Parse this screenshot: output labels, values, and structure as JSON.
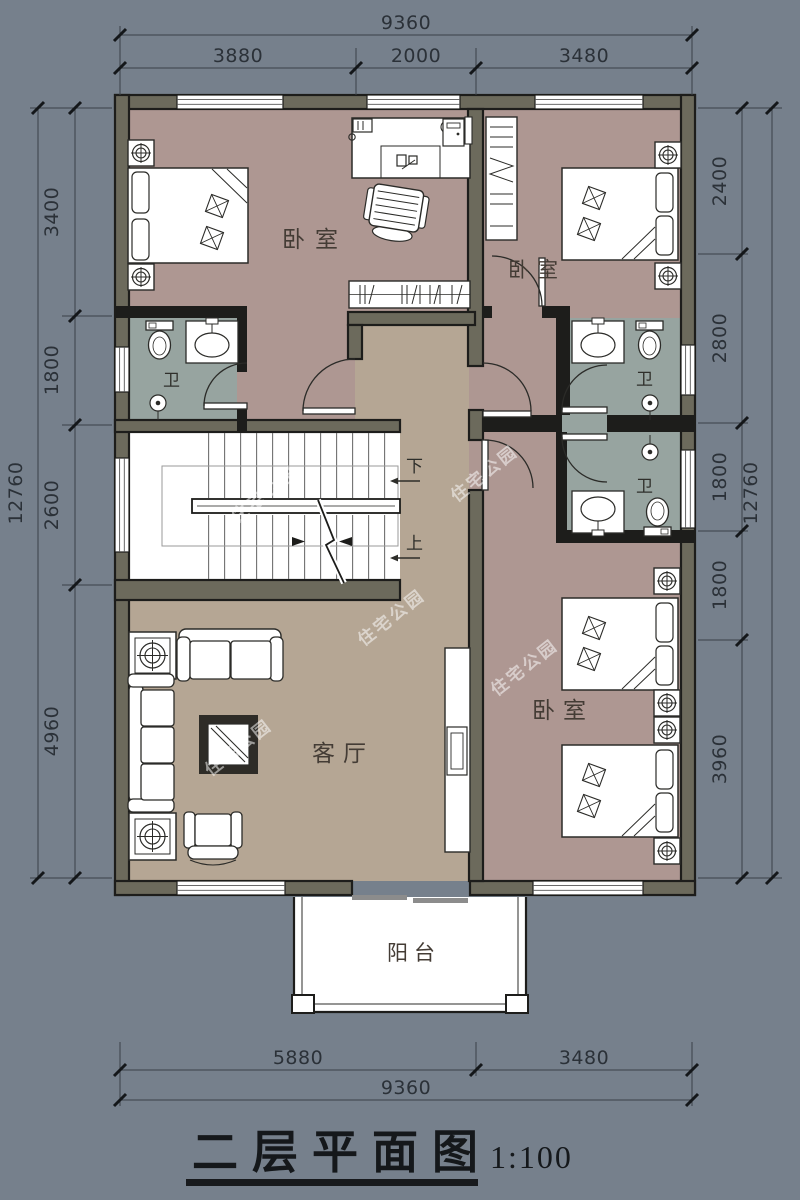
{
  "title": {
    "name": "二层平面图",
    "scale": "1:100"
  },
  "watermark": {
    "text": "住宅公园"
  },
  "rooms": {
    "bedroom_top_left": "卧室",
    "bedroom_top_right": "卧室",
    "bedroom_bottom_right": "卧室",
    "bathroom_left": "卫",
    "bathroom_right_top": "卫",
    "bathroom_right_middle": "卫",
    "living_room": "客厅",
    "balcony": "阳台"
  },
  "stairs": {
    "down_label": "下",
    "up_label": "上"
  },
  "dimensions": {
    "top": {
      "total": "9360",
      "segments": [
        "3880",
        "2000",
        "3480"
      ]
    },
    "bottom": {
      "total": "9360",
      "segments": [
        "5880",
        "3480"
      ]
    },
    "left": {
      "total": "12760",
      "segments": [
        "3400",
        "1800",
        "2600",
        "4960"
      ]
    },
    "right": {
      "total": "12760",
      "segments": [
        "2400",
        "2800",
        "1800",
        "1800",
        "3960"
      ]
    }
  },
  "colors": {
    "background": "#76808C",
    "bedroom_floor": "#AE9792",
    "living_floor": "#B5A694",
    "bathroom_floor": "#97A4A0",
    "wall_fill": "#6C6A5C",
    "wall_dark": "#1D1D1B",
    "stair_fill": "#FFFFFF"
  }
}
